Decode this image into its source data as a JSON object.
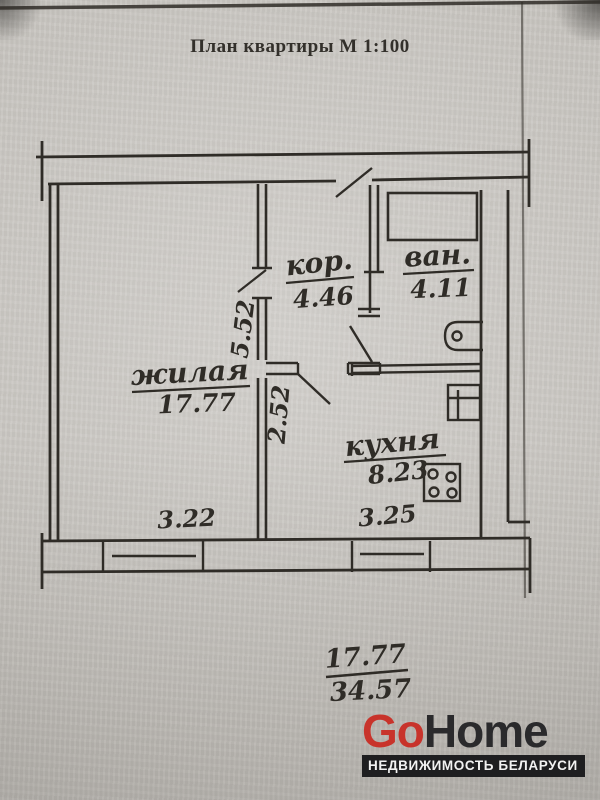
{
  "page": {
    "title": "План квартиры М 1:100"
  },
  "plan": {
    "rooms": [
      {
        "name": "кор.",
        "area": "4.46"
      },
      {
        "name": "ван.",
        "area": "4.11"
      },
      {
        "name": "жилая",
        "area": "17.77"
      },
      {
        "name": "кухня",
        "area": "8.23"
      }
    ],
    "dimensions": {
      "width_living": "3.22",
      "width_kitchen": "3.25",
      "depth_upper": "5.52",
      "depth_lower": "2.52"
    },
    "totals": {
      "living_area": "17.77",
      "total_area": "34.57"
    }
  },
  "logo": {
    "brand_go": "Go",
    "brand_home": "Home",
    "tagline": "НЕДВИЖИМОСТЬ БЕЛАРУСИ"
  },
  "colors": {
    "ink": "#2f2c27",
    "paper": "#c7c4bf",
    "logo_accent": "#c8332b",
    "logo_dark": "#2a2a2c",
    "tagline_bg": "#1e1e20"
  }
}
